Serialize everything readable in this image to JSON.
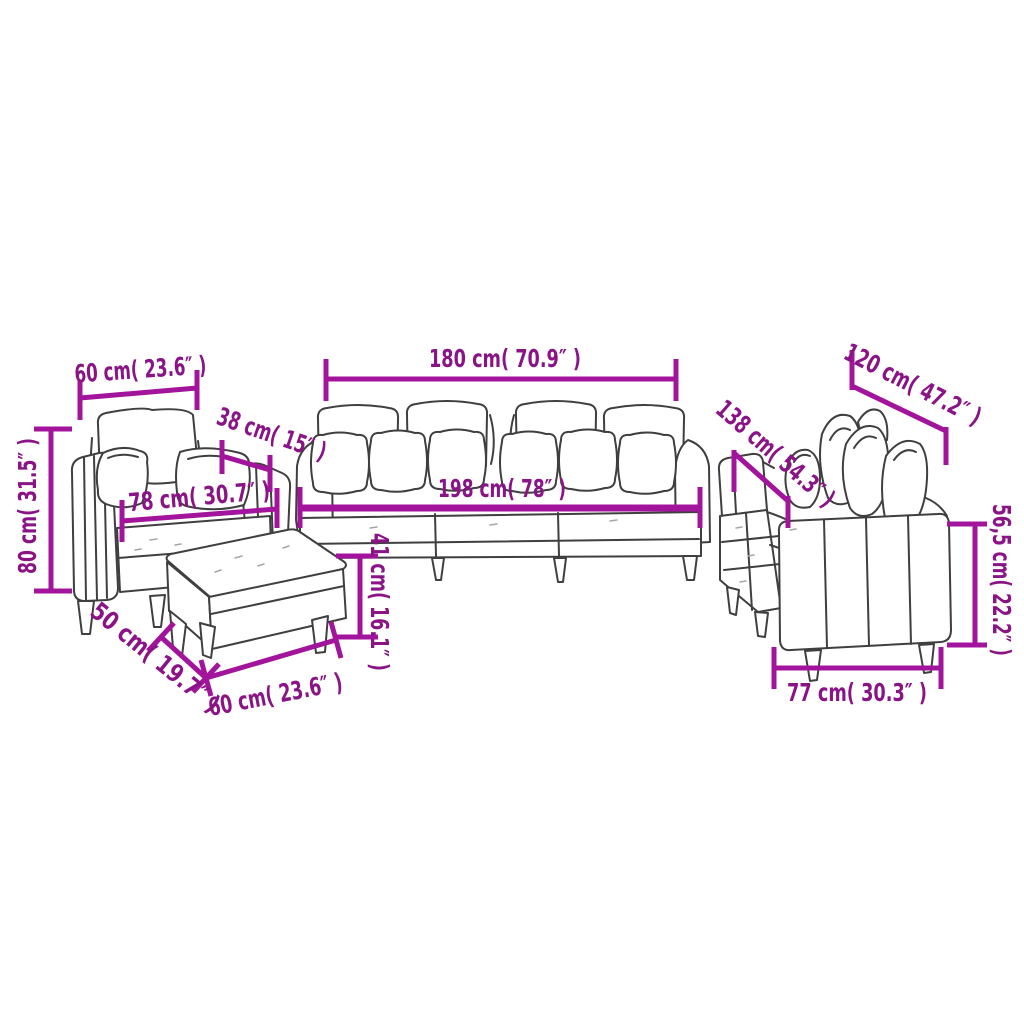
{
  "diagram": {
    "kind": "sofa-set-dimension-diagram",
    "background": "#ffffff",
    "dimension_line_color": "#a2149b",
    "dimension_text_color": "#8a1486",
    "furniture_outline_color": "#3f3f3f"
  },
  "measurements": {
    "armchair_back_width": "60 cm( 23.6″ )",
    "armchair_arm_depth": "38 cm( 15″ )",
    "armchair_seat_width": "78 cm( 30.7″ )",
    "armchair_height": "80 cm( 31.5″ )",
    "footstool_depth": "50 cm( 19.7″ )",
    "footstool_width": "60 cm( 23.6″ )",
    "footstool_height": "41 cm( 16.1″ )",
    "sofa_back_width": "180 cm( 70.9″ )",
    "sofa_total_width": "198 cm( 78″ )",
    "loveseat_length_upper": "120 cm( 47.2″ )",
    "loveseat_total_length": "138 cm( 54.3″ )",
    "loveseat_seat_height": "56,5 cm( 22.2″ )",
    "loveseat_depth": "77 cm( 30.3″ )"
  }
}
